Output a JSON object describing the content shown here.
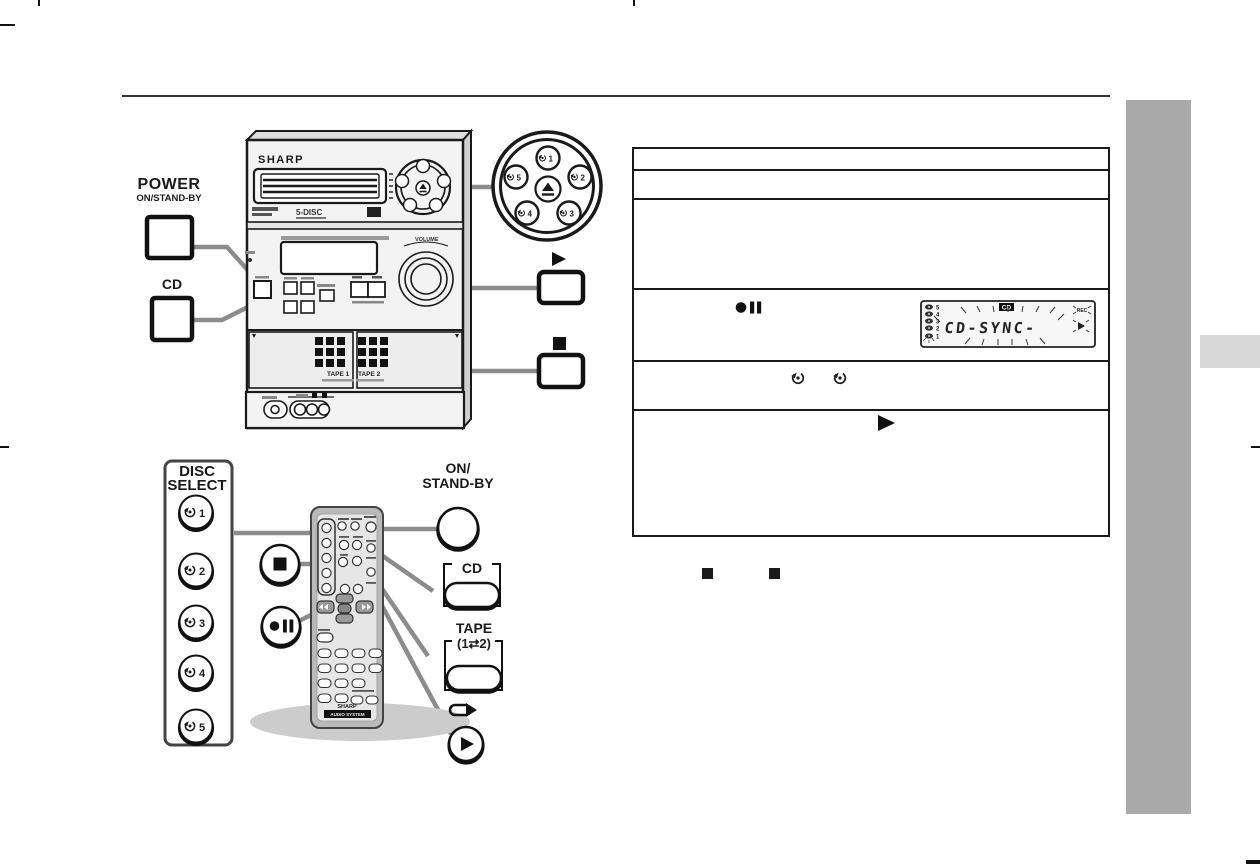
{
  "page": {
    "background": "#ffffff",
    "ink": "#1a1a1a",
    "callout_line_color": "#8c8c8c",
    "sidebar_color": "#a9a9a9",
    "sidebar_tab_color": "#d8d8d8"
  },
  "unit": {
    "brand": "SHARP",
    "disc_badge": "5-DISC",
    "volume_label": "VOLUME",
    "tape1_label": "TAPE 1",
    "tape2_label": "TAPE 2"
  },
  "power_callout": {
    "title": "POWER",
    "subtitle": "ON/STAND-BY"
  },
  "cd_callout": {
    "label": "CD"
  },
  "disc_pad": {
    "numbers": [
      "1",
      "2",
      "3",
      "4",
      "5"
    ]
  },
  "disc_select": {
    "title_line1": "DISC",
    "title_line2": "SELECT",
    "numbers": [
      "1",
      "2",
      "3",
      "4",
      "5"
    ]
  },
  "remote": {
    "brand": "SHARP",
    "system_bar": "AUDIO SYSTEM"
  },
  "remote_callouts": {
    "on_standby_line1": "ON/",
    "on_standby_line2": "STAND-BY",
    "cd": "CD",
    "tape_line1": "TAPE",
    "tape_line2": "(1⇄2)"
  },
  "icons": {
    "play": "play-triangle",
    "stop": "stop-square",
    "record_pause": "record-pause",
    "eject": "eject",
    "disc": "disc-select-arrow",
    "tape_direction": "tape-direction-arrow"
  },
  "lcd": {
    "badge": "CD",
    "display_text": "CD-SYNC-",
    "rec": "REC",
    "disc_numbers": [
      "5",
      "4",
      "3",
      "2",
      "1"
    ]
  },
  "table": {
    "row_count": 6
  }
}
